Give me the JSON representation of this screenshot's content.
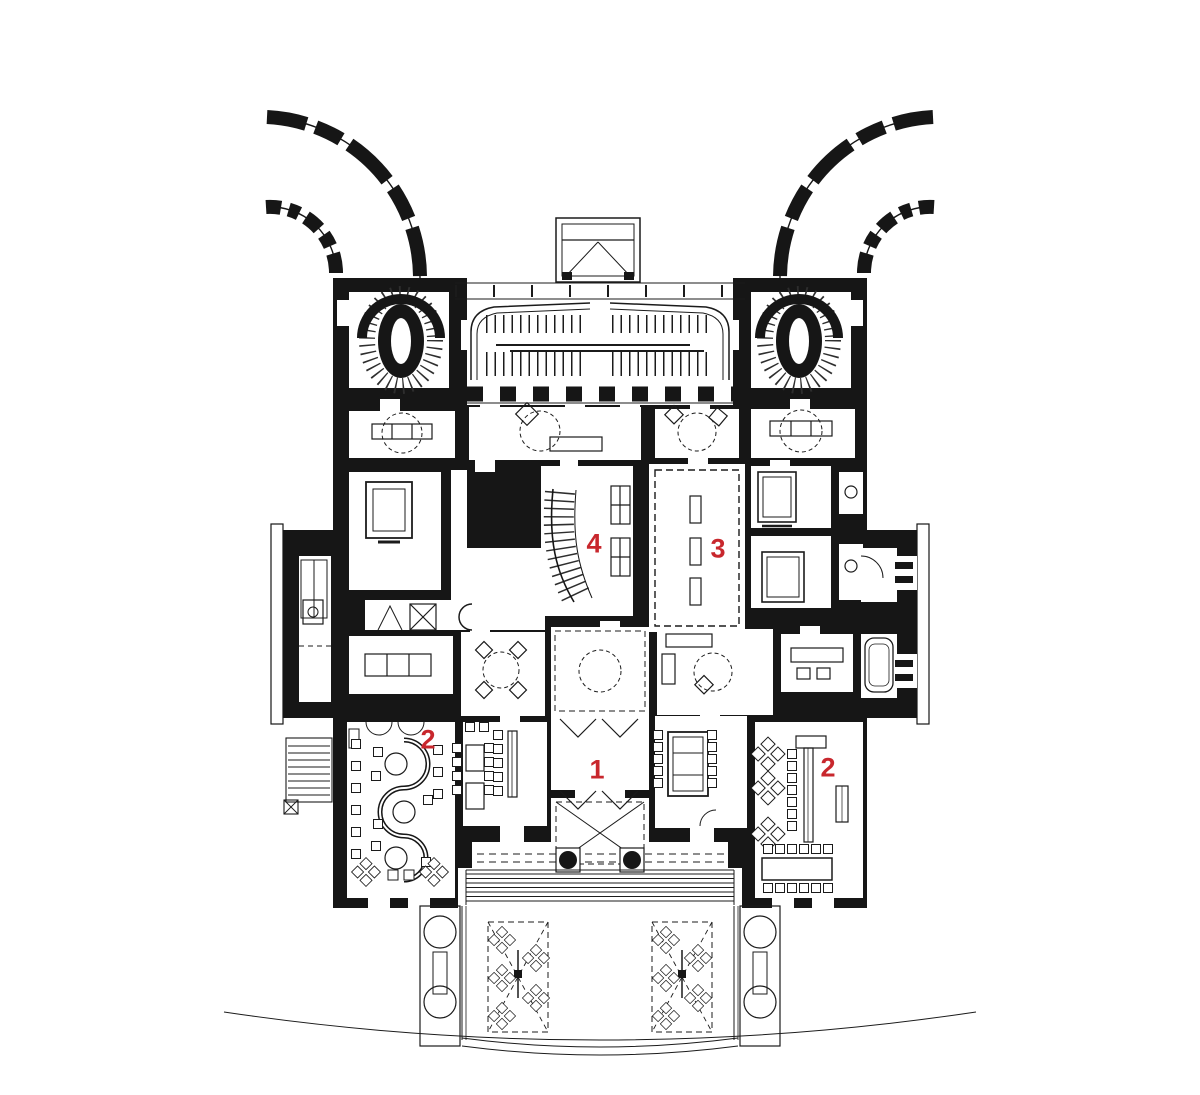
{
  "plan": {
    "background_color": "#ffffff",
    "ink_color": "#161616",
    "label_color": "#c8272d",
    "labels": [
      {
        "text": "4",
        "x": 594,
        "y": 545
      },
      {
        "text": "3",
        "x": 718,
        "y": 550
      },
      {
        "text": "2",
        "x": 428,
        "y": 741
      },
      {
        "text": "1",
        "x": 597,
        "y": 771
      },
      {
        "text": "2",
        "x": 828,
        "y": 769
      }
    ]
  }
}
